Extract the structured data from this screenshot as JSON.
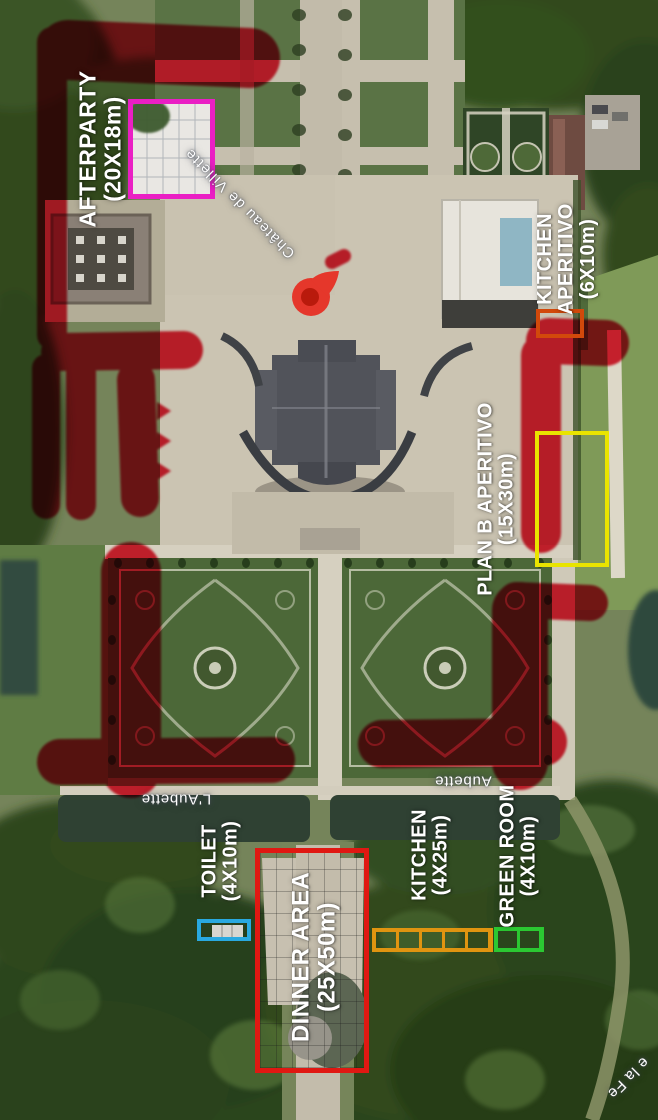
{
  "map": {
    "type": "satellite-event-plan",
    "marker_color": "#e01023",
    "pin": {
      "color": "#e5372b",
      "inner_color": "#b91a0c"
    },
    "labels": {
      "chateau": "Château de Villette",
      "stream_left": "L'Aubette",
      "stream_right": "Aubette",
      "road_partial": "e la Fe"
    }
  },
  "zones": [
    {
      "id": "afterparty",
      "label_lines": [
        "AFTERPARTY"
      ],
      "size": "(20X18m)",
      "color": "#ea1fc4"
    },
    {
      "id": "kitchen-aperitivo",
      "label_lines": [
        "KITCHEN",
        "APERITIVO"
      ],
      "size": "(6X10m)",
      "color": "#d2490b"
    },
    {
      "id": "plan-b-aperitivo",
      "label_lines": [
        "PLAN B APERITIVO"
      ],
      "size": "(15X30m)",
      "color": "#e9e400"
    },
    {
      "id": "toilet",
      "label_lines": [
        "TOILET"
      ],
      "size": "(4X10m)",
      "color": "#29a9e0"
    },
    {
      "id": "dinner-area",
      "label_lines": [
        "DINNER AREA"
      ],
      "size": "(25X50m)",
      "color": "#e01812"
    },
    {
      "id": "kitchen",
      "label_lines": [
        "KITCHEN"
      ],
      "size": "(4X25m)",
      "color": "#e09410"
    },
    {
      "id": "green-room",
      "label_lines": [
        "GREEN ROOM"
      ],
      "size": "(4X10m)",
      "color": "#2bc832"
    }
  ]
}
